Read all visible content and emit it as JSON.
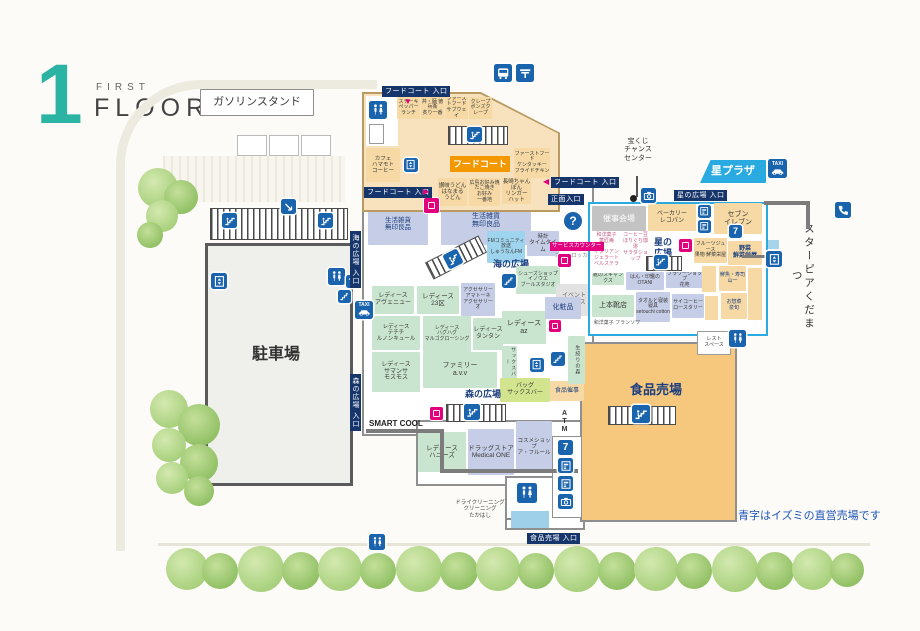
{
  "header": {
    "floor_number": "1",
    "floor_word_small": "FIRST",
    "floor_word_large": "FLOOR"
  },
  "note": {
    "text": "青字はイズミの直営売場です"
  },
  "outside": {
    "gas_station": "ガソリンスタンド",
    "lottery": "宝くじ\nチャンス\nセンター",
    "star_pia": "スターピアくだまつ",
    "parking": "駐車場"
  },
  "entrances": {
    "ft_top": "フードコート 入口",
    "ft_left": "フードコート 入口",
    "ft_right": "フードコート 入口",
    "main": "正面入口",
    "hoshi": "星の広場 入口",
    "food": "食品売場 入口",
    "umi": "海の広場 入口",
    "mori": "森の広場 入口"
  },
  "foodcourt": {
    "badge": "フードコート",
    "chips": [
      "ステーキ\nペッパーランチ",
      "丼・麺 徳兵衛\n炙り一番",
      "ファーストフード\nサブウェイ",
      "クレープ\nポンズクレープ"
    ],
    "kfc": "ファーストフード\nケンタッキー\nフライドチキン",
    "cafe": "カフェ\nハマモト\nコーヒー",
    "udon": "讃岐うどん\nはなまる\nうどん",
    "okonomi": "広島お好み焼\nたこ焼き\nお好み\n一番地",
    "ringer": "長崎ちゃんぽん\nリンガー\nハット"
  },
  "plazas": {
    "umi": "海の広場",
    "mori": "森の広場",
    "hoshi": "星の\n広場"
  },
  "center": {
    "muji": "生活雑貨\n無印良品",
    "fm": "FMコミュニティ放送\nしゅうなんFM",
    "timetime": "時計\nタイムタイム",
    "service_counter": "サービスカウンター",
    "coin_locker": "コインロッカー",
    "inoue": "シューズショップ\nイノウエ\nブールスタジオ",
    "event_space": "イベント\nスペース",
    "cosmetics": "化粧品"
  },
  "ladies": {
    "avenue": "レディース\nアヴェニュー",
    "ku23": "レディース\n23区",
    "amatone": "アクセサリー\nアマトーネ\nアクセサリーオ",
    "techichi": "レディース\nテチチ\nルノンキュール",
    "hughug": "レディース\nハグハグ\nマルゴクローシング",
    "tantan": "レディース\nタンタン",
    "samansa": "レディース\nサマンサ\nモスモス",
    "avv": "ファミリー\na.v.v",
    "az": "レディース\naz",
    "honeys": "レディース\nハニーズ"
  },
  "south": {
    "smart_cool": "SMART COOL",
    "medical": "ドラッグストア\nMedical ONE",
    "afleur": "コスメショップ\nア・フルール",
    "sacsbar_v": "サックスバー",
    "sacsbar": "バッグ\nサックスバー",
    "food_event": "食品催事",
    "cleaning": "ドライクリーニング\nクリーニング\nたかはし",
    "atm": "ATM",
    "juice": "生絞りの森"
  },
  "hoshi_plaza": {
    "tab": "星プラザ",
    "event_hall": "催事会場",
    "bakery": "ベーカリー\nレコパン",
    "seven": "セブン\nイレブン",
    "fruits": "フルーツジュース\n果物 鮮菜栄屋",
    "veggie": "野菜\n鮮菜栄屋",
    "sweets": "和洋菓子\n菓匠庵",
    "gelato": "イタリアン\nジェラート\nベルステラ",
    "beans": "コーヒー豆\nほりぐち珈琲",
    "salad": "サラダショップ",
    "shoes_strip": "靴のスキャンクス",
    "otani": "はん・印鑑の\nOTANI",
    "flower": "フラワーショップ\n花苑",
    "uemoto": "上本靴店",
    "setouchi": "タオルと寝装寝具\nsetouchi cotton",
    "sai": "サイコーヒー\nロースタリー",
    "francois": "和洋菓子 フランソワ",
    "yamaichi": "鮮魚・寿司\n山一",
    "izushun": "お惣菜\n泉旬"
  },
  "food_floor": {
    "label": "食品売場",
    "rest_space": "レスト\nスペース"
  },
  "icon_text": {
    "taxi": "TAXI",
    "seven": "7",
    "info": "?"
  },
  "icons": {
    "arrow_down": "▼",
    "arrow_right": "▶",
    "arrow_left": "◀"
  },
  "colors": {
    "accent_cyan": "#29abe2",
    "icon_blue": "#1a63ad",
    "pink": "#e3007f",
    "navy_label": "#16356b",
    "tan": "#f6d9a4",
    "green": "#c9e5cf",
    "lavender": "#c6cde6",
    "orange_area": "#f6c87e",
    "teal_title": "#2bb3a3",
    "note_blue": "#1d55b8"
  }
}
